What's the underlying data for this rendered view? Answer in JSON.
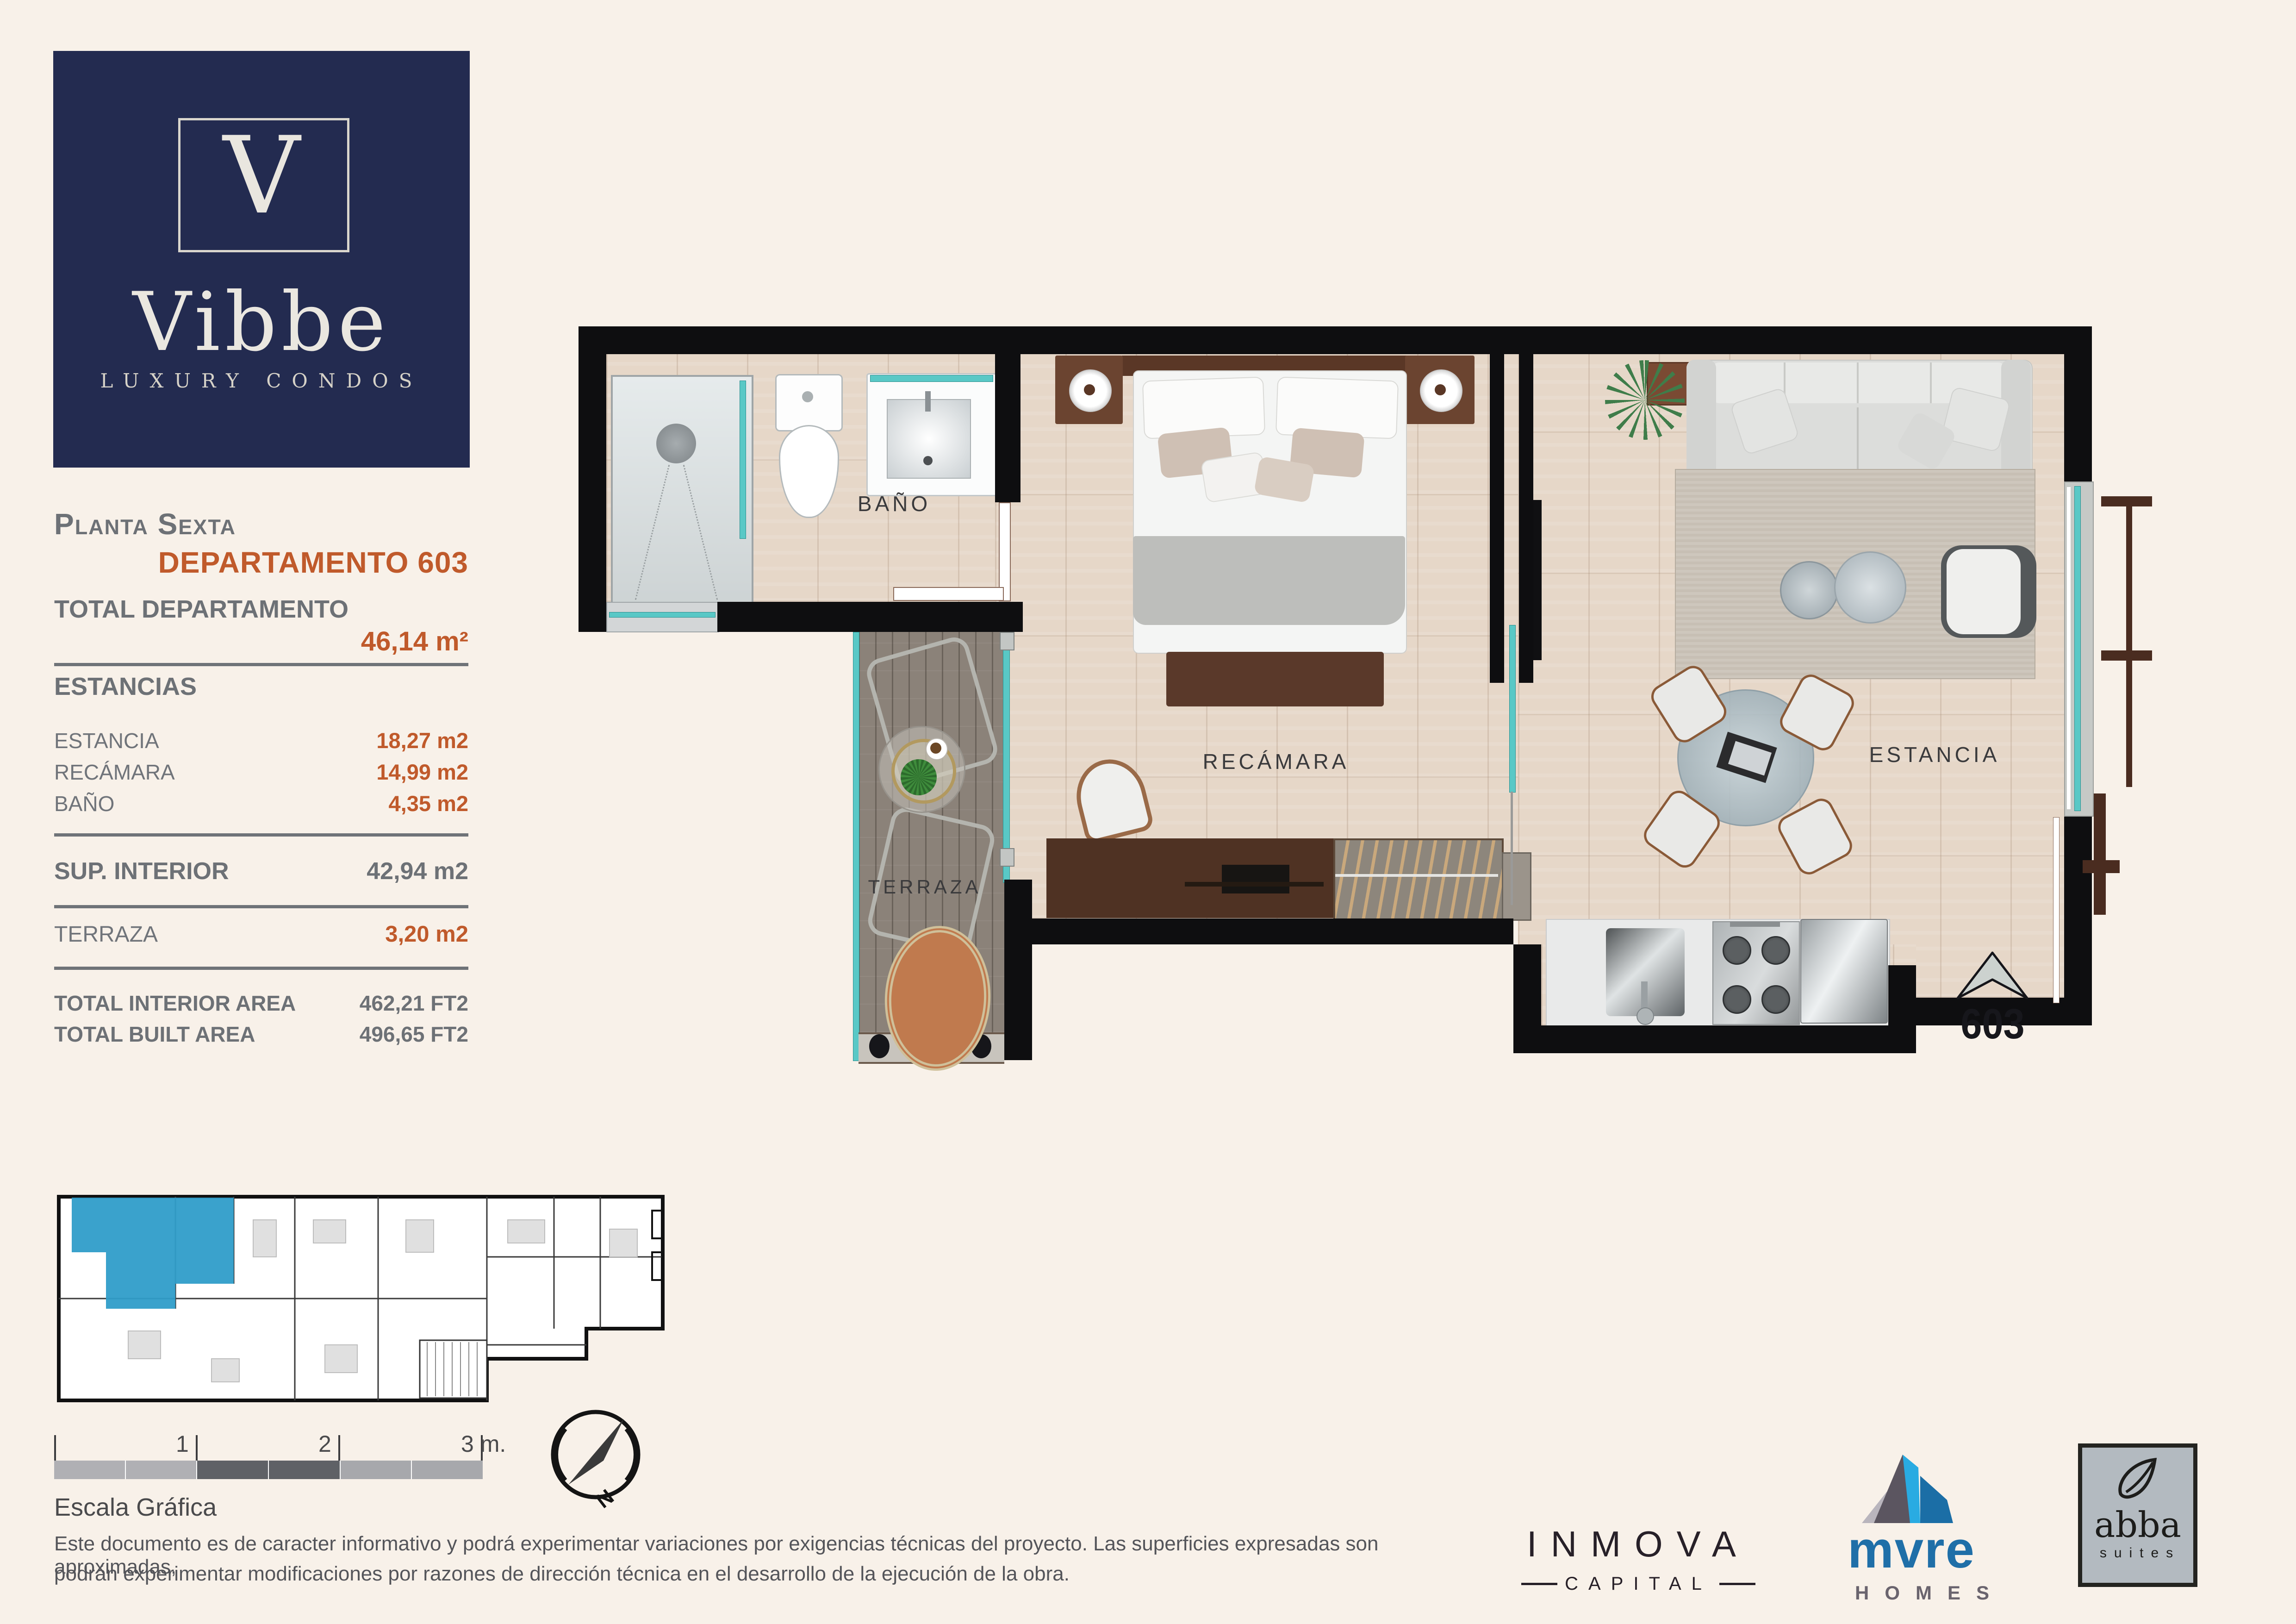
{
  "title": {
    "brand_initial": "V",
    "brand_name": "Vibbe",
    "brand_tagline": "LUXURY CONDOS"
  },
  "info": {
    "floor_label": "Planta Sexta",
    "unit_title": "DEPARTAMENTO 603",
    "total_label": "TOTAL DEPARTAMENTO",
    "total_value": "46,14 m²",
    "estancias_header": "ESTANCIAS",
    "room_rows": [
      {
        "label": "ESTANCIA",
        "value": "18,27 m2"
      },
      {
        "label": "RECÁMARA",
        "value": "14,99 m2"
      },
      {
        "label": "BAÑO",
        "value": "4,35 m2"
      }
    ],
    "sup_interior_label": "SUP. INTERIOR",
    "sup_interior_value": "42,94 m2",
    "terraza_label": "TERRAZA",
    "terraza_value": "3,20 m2",
    "total_rows": [
      {
        "label": "TOTAL INTERIOR AREA",
        "value": "462,21 FT2"
      },
      {
        "label": "TOTAL BUILT AREA",
        "value": "496,65 FT2"
      }
    ]
  },
  "plan": {
    "room_labels": {
      "bano": "BAÑO",
      "recamara": "RECÁMARA",
      "estancia": "ESTANCIA",
      "terraza": "TERRAZA"
    },
    "unit_number": "603"
  },
  "scale": {
    "tick_1": "1",
    "tick_2": "2",
    "tick_3": "3 m.",
    "caption": "Escala Gráfica"
  },
  "compass": {
    "north": "N"
  },
  "disclaimer": {
    "line1": "Este documento es de caracter informativo y podrá experimentar variaciones por exigencias técnicas del proyecto. Las superficies expresadas son aproximadas,",
    "line2": "podrán experimentar modificaciones por razones de dirección técnica en el desarrollo de la ejecución de la obra."
  },
  "partners": {
    "inmova": {
      "name": "INMOVA",
      "sub": "CAPITAL"
    },
    "mvre": {
      "name": "mvre",
      "sub": "HOMES"
    },
    "abba": {
      "name": "abba",
      "sub": "suites"
    }
  },
  "colors": {
    "accent_orange": "#c05a2b",
    "brand_navy": "#232b50",
    "muted_gray": "#6d7176",
    "teal_glass": "#59c8c6",
    "highlight_blue": "#2f9dc9",
    "background": "#f8f1e9"
  }
}
